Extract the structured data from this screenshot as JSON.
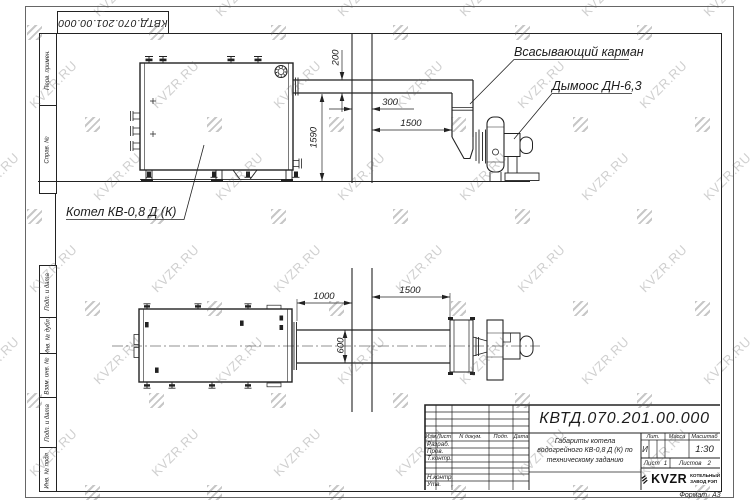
{
  "watermark": {
    "text": "KVZR.RU"
  },
  "corner_stamp": {
    "doc_number": "КВТД.070.201.00.000"
  },
  "side_strip": {
    "items": [
      "Перв. примен.",
      "Справ. №",
      "Подп. и дата",
      "Инв. № дубл.",
      "Взам. инв. №",
      "Подп. и дата",
      "Инв. № подл."
    ]
  },
  "drawing": {
    "labels": {
      "suction_pocket": "Всасывающий карман",
      "smoke_exhauster": "Дымоос ДН-6,3",
      "boiler": "Котел КВ-0,8  Д  (К)"
    },
    "dimensions": {
      "elevation": {
        "duct_height": "200",
        "wall_depth": "300",
        "wall_to_fan": "1500",
        "duct_axis_height": "1590"
      },
      "plan": {
        "boiler_to_wall": "1000",
        "wall_to_fan": "1500",
        "duct_width": "600"
      }
    }
  },
  "title_block": {
    "doc_number": "КВТД.070.201.00.000",
    "header_columns": [
      "Изм",
      "Лист",
      "N докум.",
      "Подп.",
      "Дата"
    ],
    "signature_rows": [
      "Разраб.",
      "Пров.",
      "Т.контр.",
      "Н.контр.",
      "Утв."
    ],
    "description": "Габариты котела водогрейного КВ-0,8 Д (К) по техническому заданию",
    "lit_label": "Лит.",
    "lit_value": "И",
    "mass_label": "Масса",
    "scale_label": "Масштаб",
    "scale_value": "1:30",
    "sheet_label": "Лист",
    "sheet_value": "1",
    "sheets_label": "Листов",
    "sheets_value": "2",
    "company": {
      "logo_text": "KVZR",
      "name_line1": "КОТЕЛЬНЫЙ",
      "name_line2": "ЗАВОД РЭП"
    },
    "format_label": "Формат",
    "format_value": "А3"
  }
}
